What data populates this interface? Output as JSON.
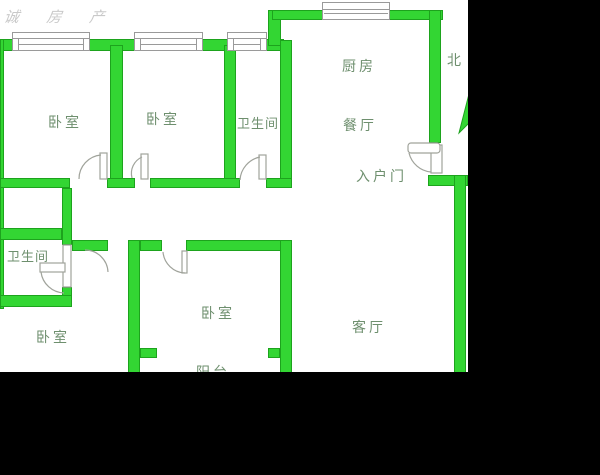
{
  "meta": {
    "type": "residential-floor-plan"
  },
  "watermark": {
    "text": "诚 房 产"
  },
  "compass": {
    "north_label": "北"
  },
  "rooms": {
    "bedroom_top_left": "卧室",
    "bedroom_top_mid": "卧室",
    "bathroom_top": "卫生间",
    "kitchen": "厨房",
    "dining": "餐厅",
    "entrance": "入户门",
    "bathroom_left": "卫生间",
    "bedroom_bottom_left": "卧室",
    "bedroom_bottom_mid": "卧室",
    "living": "客厅",
    "balcony": "阳台"
  },
  "colors": {
    "wall_fill": "#33d633",
    "wall_border": "#1da31d",
    "floor": "#ffffff",
    "background": "#000000",
    "label": "#6e8f6e",
    "door_line": "#a0a39b",
    "win_line": "#9a9a9a",
    "watermark": "#c9c9c9"
  }
}
